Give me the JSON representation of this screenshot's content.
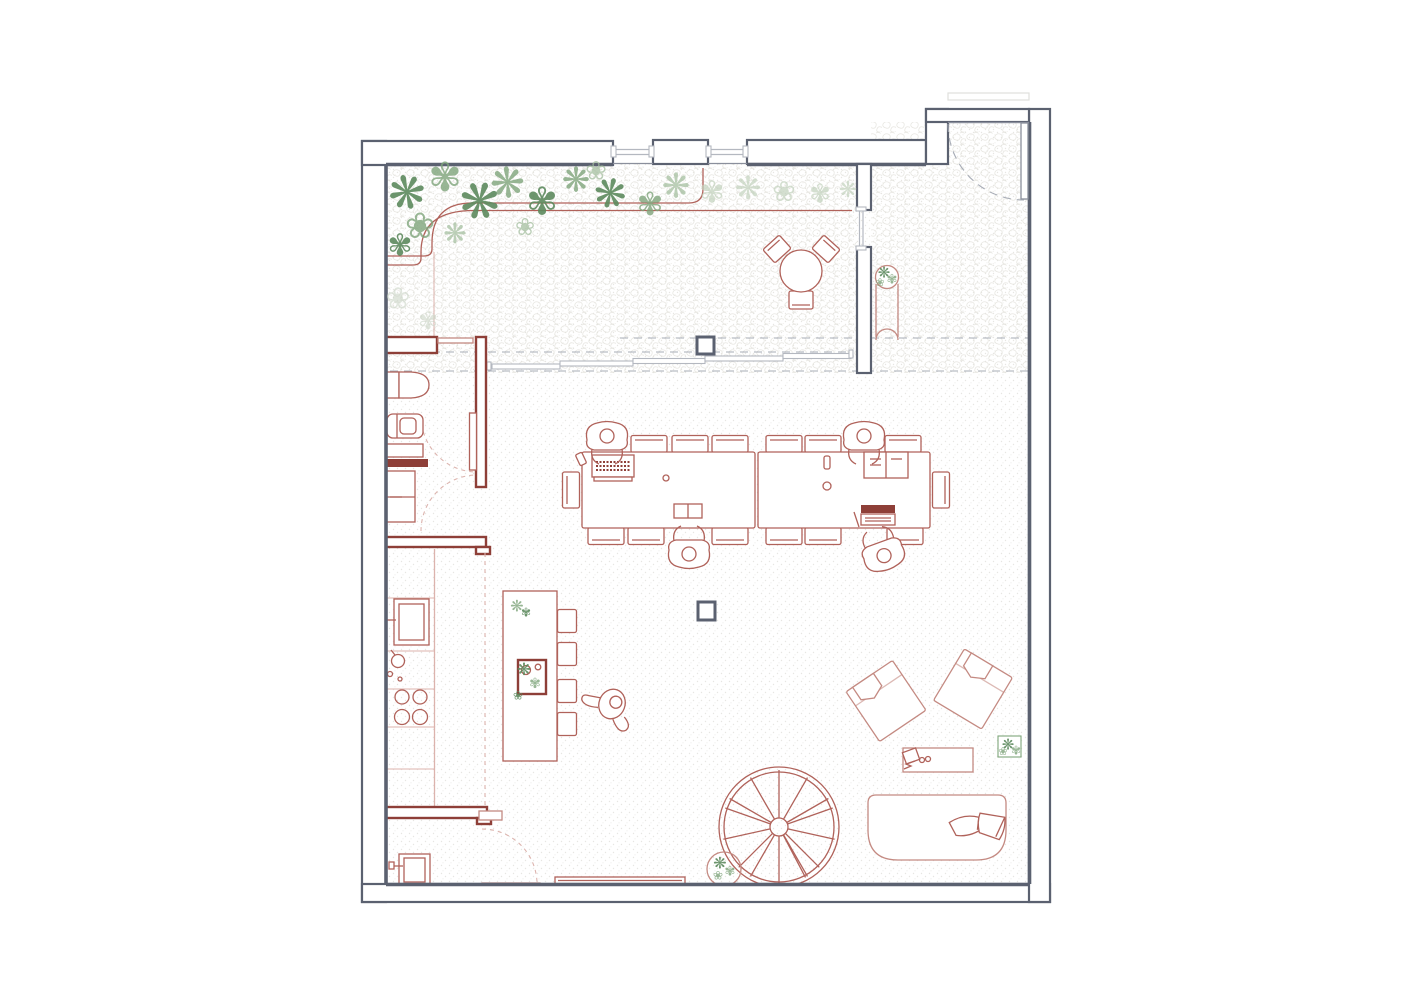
{
  "document": {
    "type": "architectural floor plan",
    "description": "Top-view line drawing of an open loft / co-working apartment floor. Dark grey exterior walls, muted red furniture linework, green plants, speckled floor texture. No text labels appear in the drawing."
  },
  "colors": {
    "wall": "#5b6170",
    "wall_light": "#8a8f9c",
    "red": "#b0625a",
    "redwall": "#8e3f38",
    "soft": "#c48a82",
    "dashg": "#a7acb6",
    "dashp": "#dcb3ad",
    "glass": "#b4b8c0",
    "dot": "#e7e6e2",
    "cob": "#e3e2dc",
    "p1": "#5d8a5e",
    "p2": "#7fa57b",
    "p3": "#a5bfa0",
    "p4": "#c2d2bd",
    "p5": "#ccd6c8"
  },
  "glyphs": {
    "plant_a": "❋",
    "plant_b": "✾",
    "plant_c": "❀"
  },
  "zones": [
    {
      "name": "planted terrace strip",
      "items": [
        "curved planting bed",
        "trees and shrubs",
        "round bistro table",
        "3 bistro chairs",
        "sliding glass door wall with 5 panels"
      ]
    },
    {
      "name": "entry strip",
      "items": [
        "entry door with swing arc",
        "plant console with potted plant",
        "cobblestone paving"
      ]
    },
    {
      "name": "work hall",
      "items": [
        "2 long work tables",
        "14 chairs",
        "4 seated people",
        "2 laptops",
        "2 open books",
        "2 structural columns"
      ]
    },
    {
      "name": "bathroom",
      "items": [
        "2 toilets",
        "washbasin counter",
        "storage cabinet",
        "red partition walls",
        "2 door swing arcs"
      ]
    },
    {
      "name": "kitchen",
      "items": [
        "wall counter",
        "oven",
        "kettle",
        "4-burner hob",
        "island with sink",
        "4 bar stools",
        "2 potted plants",
        "1 walking person"
      ]
    },
    {
      "name": "laundry corner",
      "items": [
        "washing machine",
        "red wall segment",
        "door swing arc",
        "bench along wall"
      ]
    },
    {
      "name": "lounge",
      "items": [
        "2 angled armchairs",
        "coffee table with book, glasses and pen",
        "rounded daybed with 2 cushions",
        "2 potted plants"
      ]
    },
    {
      "name": "stair",
      "items": [
        "spiral staircase with 13 treads",
        "potted plant"
      ]
    }
  ],
  "counts": {
    "people": 5,
    "columns": 2,
    "sliding_panels": 5,
    "work_table_chairs": 14,
    "bar_stools": 4,
    "spiral_treads": 13
  }
}
